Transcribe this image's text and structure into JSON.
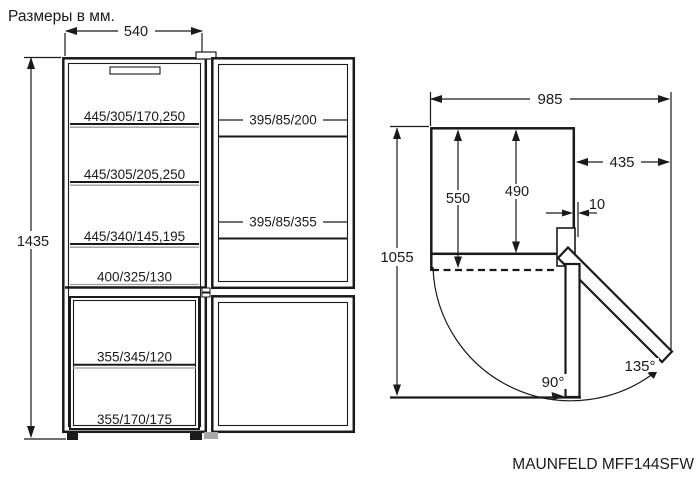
{
  "title": "Размеры в мм.",
  "model": "MAUNFELD MFF144SFW",
  "front_view": {
    "width": "540",
    "height": "1435",
    "fridge_shelves": [
      "445/305/170,250",
      "445/305/205,250",
      "445/340/145,195",
      "400/325/130"
    ],
    "freezer_shelves": [
      "355/345/120",
      "355/170/175"
    ],
    "door_shelves": [
      "395/85/200",
      "395/85/355"
    ]
  },
  "top_view": {
    "total_width": "985",
    "side_clearance": "435",
    "depth_with_door": "550",
    "depth_case": "490",
    "wall_gap": "10",
    "depth_door_open": "1055",
    "angle_90": "90°",
    "angle_135": "135°"
  },
  "colors": {
    "line": "#1a1a1a",
    "shelf_accent": "#9b9b9b",
    "background": "#ffffff"
  }
}
